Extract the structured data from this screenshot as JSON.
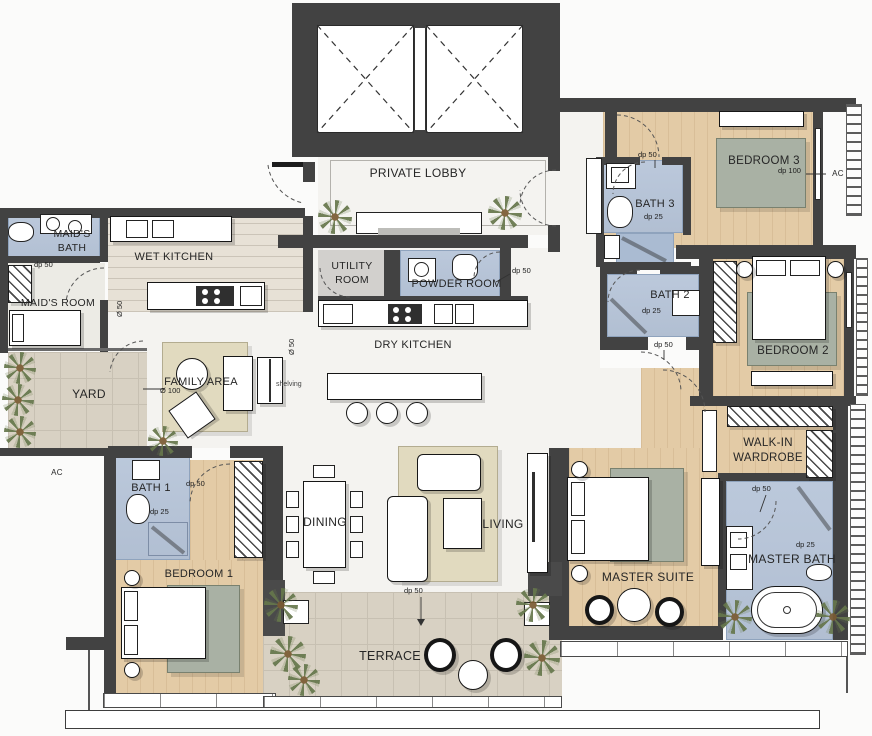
{
  "title": "Apartment floor plan",
  "colors": {
    "wall": "#424242",
    "bath_floor": "#b7c5d9",
    "wood_floor": "#e3cba6",
    "tile_floor": "#d8d1c3",
    "rug_green": "#a9b1a4",
    "rug_beige": "#e1dabf",
    "utility_floor": "#d2d0cd",
    "marble_floor": "#f4f3f0",
    "plant_green": "#66774c"
  },
  "labels": {
    "private_lobby": "PRIVATE LOBBY",
    "wet_kitchen": "WET KITCHEN",
    "utility_room": "UTILITY ROOM",
    "powder_room": "POWDER ROOM",
    "dry_kitchen": "DRY KITCHEN",
    "maids_bath": "MAID'S BATH",
    "maids_room": "MAID'S ROOM",
    "yard": "YARD",
    "family_area": "FAMILY AREA",
    "bath_1": "BATH 1",
    "bedroom_1": "BEDROOM 1",
    "dining": "DINING",
    "living": "LIVING",
    "terrace": "TERRACE",
    "bath_2": "BATH 2",
    "bedroom_2": "BEDROOM 2",
    "bath_3": "BATH 3",
    "bedroom_3": "BEDROOM 3",
    "walk_in_wardrobe": "WALK-IN WARDROBE",
    "master_suite": "MASTER SUITE",
    "master_bath": "MASTER BATH",
    "ac": "AC"
  },
  "annot": {
    "dp50": "dp 50",
    "dp25": "dp 25",
    "dp100": "dp 100",
    "dia50": "Ø 50",
    "dia100": "Ø 100",
    "shelving": "shelving"
  }
}
